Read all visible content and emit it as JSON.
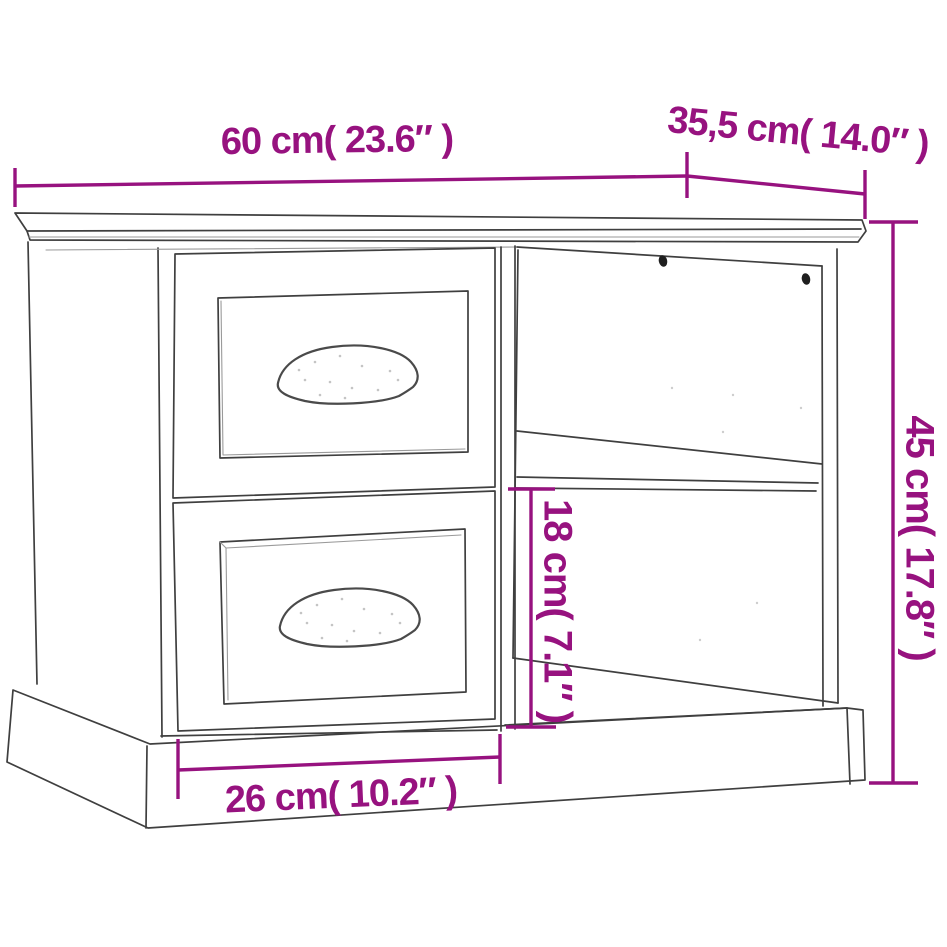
{
  "page": {
    "background_color": "#FFFFFF"
  },
  "diagram": {
    "type": "furniture-dimension-diagram",
    "subject": "bedside cabinet with two drawers and an open two-shelf compartment",
    "colors": {
      "dimension_accent": "#97127F",
      "outline": "#3F3F3F",
      "light_edge": "#9A9A9A",
      "screw": "#1F1F1F",
      "background": "#FFFFFF"
    },
    "dimensions": {
      "width": {
        "label": "60 cm( 23.6″ )"
      },
      "depth": {
        "label": "35,5 cm( 14.0″ )"
      },
      "height": {
        "label": "45 cm( 17.8″ )"
      },
      "shelf_opening_height": {
        "label": "18 cm( 7.1″ )"
      },
      "drawer_width": {
        "label": "26 cm( 10.2″ )"
      }
    }
  }
}
